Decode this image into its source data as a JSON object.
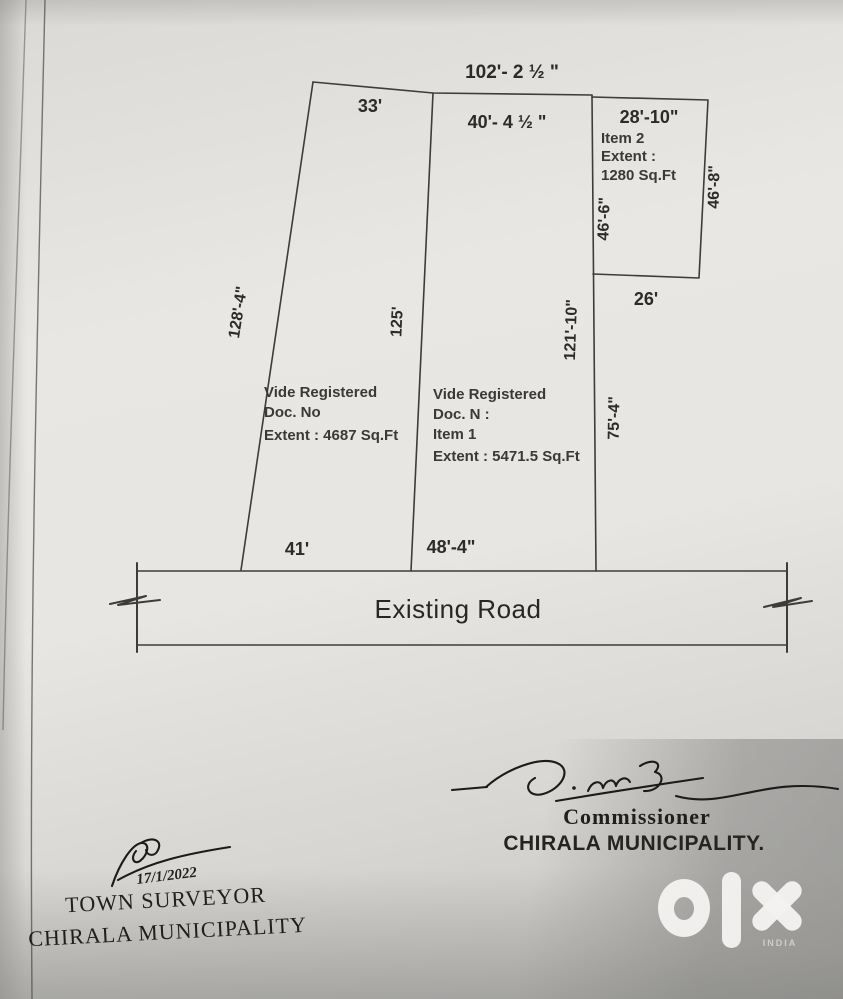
{
  "plan": {
    "top_dimension": "102'- 2 ½ \"",
    "road_label": "Existing Road",
    "plot_left": {
      "top": "33'",
      "side_left": "128'-4\"",
      "side_right": "125'",
      "bottom": "41'",
      "stamp_line1": "Vide Registered",
      "stamp_line2": "Doc. No",
      "stamp_line3": "Extent : 4687 Sq.Ft"
    },
    "plot_middle": {
      "top": "40'- 4 ½ \"",
      "side_right": "121'-10\"",
      "bottom": "48'-4\"",
      "stamp_line1": "Vide Registered",
      "stamp_line2": "Doc. N :",
      "stamp_line3": "Item 1",
      "stamp_line4": "Extent : 5471.5 Sq.Ft"
    },
    "plot_item2": {
      "top": "28'-10\"",
      "label_line1": "Item 2",
      "label_line2": "Extent :",
      "label_line3": "1280 Sq.Ft",
      "side_left": "46'-6\"",
      "side_right": "46'-8\"",
      "bottom": "26'",
      "side_below": "75'-4\""
    }
  },
  "signatures": {
    "commissioner_title": "Commissioner",
    "commissioner_org": "CHIRALA MUNICIPALITY.",
    "surveyor_date": "17/1/2022",
    "surveyor_title": "TOWN SURVEYOR",
    "surveyor_org": "CHIRALA MUNICIPALITY"
  },
  "watermark": {
    "brand": "OLX",
    "country": "INDIA"
  },
  "colors": {
    "ink": "#2c2b29",
    "line": "#3d3c3a",
    "paper": "#e7e5e1",
    "watermark": "#f3f2f0"
  }
}
